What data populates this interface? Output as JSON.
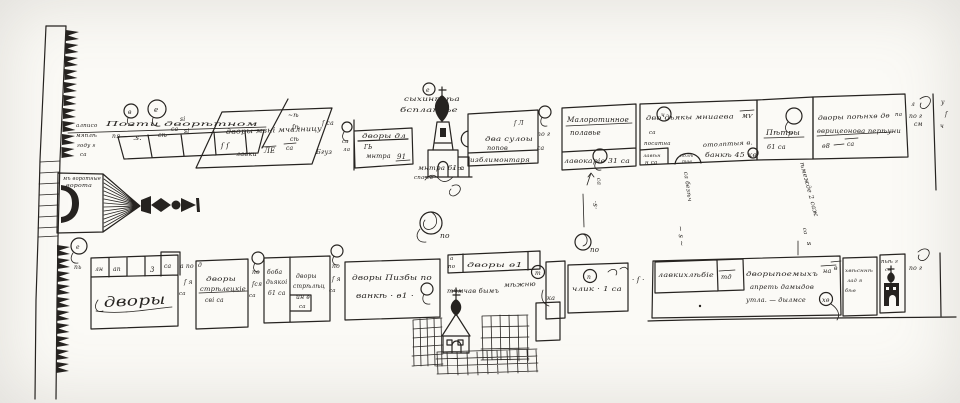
{
  "document": {
    "kind": "hand-drawn manuscript street plan",
    "paper_color": "#fbfaf6",
    "ink_color": "#262320"
  },
  "labels": {
    "gate": {
      "l1": "мъ воротные",
      "l2": "ворота"
    },
    "shops": {
      "c1": "в",
      "c2": "е",
      "cap": "Позти дворѣтном",
      "s1": "пя",
      "s2": ".ѕ.",
      "s3": "сѣ",
      "s4": "са",
      "e1": "алписо",
      "e2": "мяплѣ",
      "e3": "году ѕ",
      "e4": "са",
      "m1": "ѕі",
      "m2": "ѕі",
      "a1": "~ѣ",
      "a2": "ſѣ",
      "a3": "сѣ"
    },
    "par": {
      "l1": "дворы мзні мчалницу",
      "f": "ſ ſ",
      "s1": "лавки",
      "s2": "ЛЕ",
      "s3": "са"
    },
    "col": {
      "m1": "ſ са",
      "m2": "Бгуз",
      "m3": "са",
      "m4": "ла"
    },
    "mon": {
      "l1": "дворы дл",
      "l2": "ГЬ",
      "l3": "мнтра",
      "n": "91"
    },
    "church_top": {
      "c": "е",
      "l1": "сыхинпоѣа",
      "l2": "бсплатѣе",
      "l3": "мнтра 61 с",
      "l4": "спа са",
      "po": "по"
    },
    "suloy": {
      "f": "ſ Л",
      "l1": "два сулоы",
      "l2": "попов",
      "strip": "изблимонтаря",
      "s2": "л са"
    },
    "gap1": {
      "m1": "по г",
      "m2": "са"
    },
    "maloros": {
      "l1": "Малоротинное",
      "l2": "полавье",
      "strip": "лавокаріе 31 са"
    },
    "dyaki": {
      "c": "ч",
      "l1": "дво дьякы мниаева",
      "l2": "мѵ",
      "l3": "са",
      "l4": "посатна",
      "cell1": "лавѣн",
      "cell2": "н са",
      "arch1": "полѣ",
      "arch2": "тое",
      "l5": "отолптыя в.",
      "l6": "банкѣ 45 кѳ"
    },
    "petry": {
      "l1": "Пѣтры",
      "l2": "61 са"
    },
    "last": {
      "l1": "дворы поѣнхѳ дѳ",
      "l2": "па",
      "l3": "ѳврицеонова перѣуни",
      "l4": "ѳ8",
      "l5": "са"
    },
    "edge": {
      "l1": "л",
      "l2": "по г",
      "l3": "см",
      "u": "у",
      "s": "ſ",
      "ch": "ч"
    },
    "street": {
      "m0": "по",
      "m1a": "са",
      "m1b": "·ѕ·",
      "m1c": "по",
      "m2a": "са безѣч",
      "m2b": "~ ѕ ~",
      "m3a": "ѣмежде 2 саж",
      "m3b": "са",
      "m3c": "ѕ"
    },
    "b1": {
      "c": "е",
      "p": "пь",
      "c1": "лн",
      "c2": "ап",
      "c3": "3",
      "c4": "са",
      "main": "дворы",
      "m1": "а по",
      "m2": "ſ я",
      "m3": "са"
    },
    "b2": {
      "d": "д",
      "l1": "дворы",
      "l2": "стрѣлецкіе",
      "l3": "сві са",
      "m1": "по",
      "m2": "ſся",
      "m3": "са"
    },
    "b3": {
      "a1": "боба",
      "a2": "дьякоі",
      "a3": "61 са",
      "b1": "дворы",
      "b2": "стрѣлѣц",
      "b3": "ин ѳ",
      "b4": "са",
      "m1": "по",
      "m2": "ſ я",
      "m3": "са"
    },
    "b4": {
      "l1": "дворы Пизбы по",
      "l2": "ванкѣ · ѳ1 ·"
    },
    "b5": {
      "a": "а",
      "b": "по",
      "cells": "дворы ѳ1",
      "sub": "тчмчав бымъ"
    },
    "mezh": {
      "l1": "мѣжню",
      "c": "т",
      "l2": "ка"
    },
    "b6": {
      "c": "п",
      "l1": "члик · 1 са",
      "m": "· ſ ·"
    },
    "b7": {
      "l1": "лавкихлѣбіе",
      "cell": "тд",
      "l2": "дворыпоемыхъ",
      "na": "на",
      "l3": "апреть дамыдов",
      "l4": "утла. — дылмсе",
      "xo": "хѳ",
      "v": "в"
    },
    "b8": {
      "l1": "хвѣсннѣ",
      "l2": "лад я",
      "l3": "бѣѳ"
    },
    "b9": {
      "l1": "пьѣ г",
      "l2": "сѳ"
    },
    "b10": {
      "m1": "по г"
    }
  }
}
